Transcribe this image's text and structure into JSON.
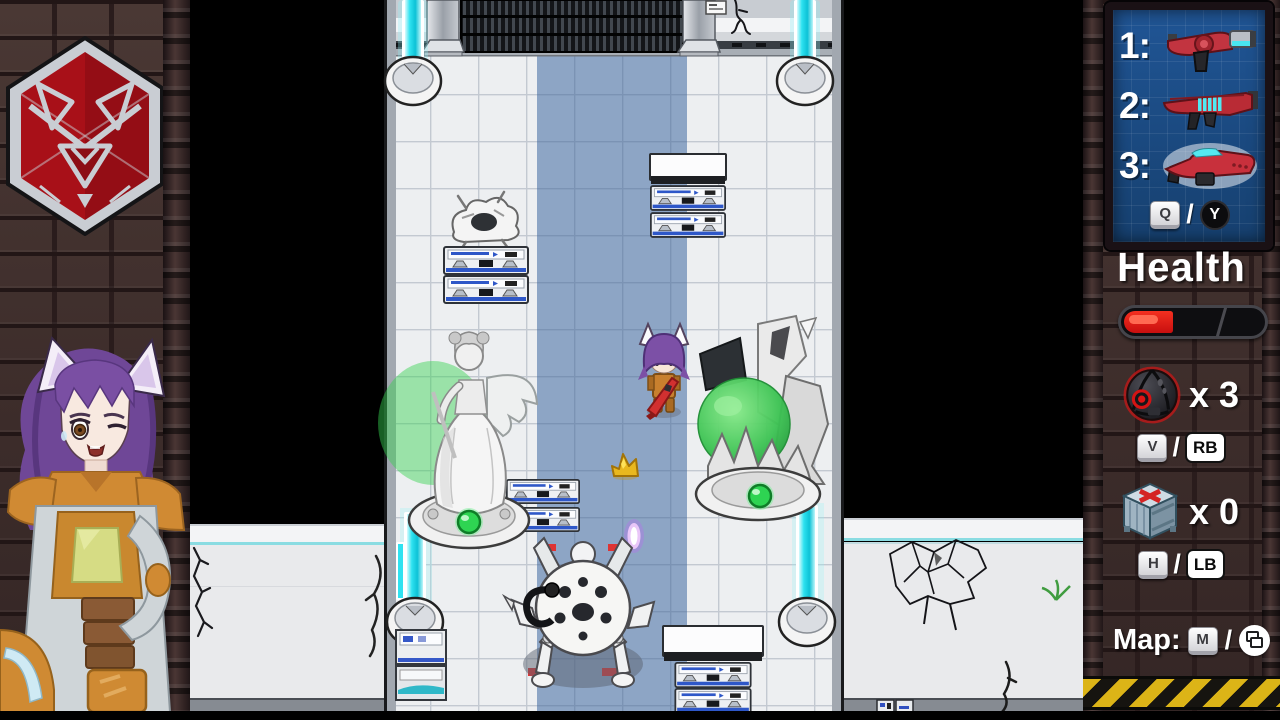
{
  "meta": {
    "description": "Top-down sci-fi action RPG gameplay screenshot with side HUD"
  },
  "left_panel": {
    "emblem_icon": "fox-hex-faction-emblem",
    "portrait_icon": "fox-eared-character-portrait",
    "colors": {
      "emblem_red": "#a81018",
      "emblem_metal": "#c9cdd3"
    }
  },
  "viewport": {
    "entities": {
      "player": "player-character-sprite",
      "enemy": "spider-robot-enemy",
      "statue_left": "winged-angel-statue",
      "statue_right": "crystal-statue",
      "wreck": "destroyed-robot-wreck",
      "pickup": "gold-pickup",
      "projectile": "plasma-projectile",
      "barrier": "cyan-energy-beam",
      "crates": "supply-crate-stack",
      "terminal": "control-terminal",
      "decal_blood": "blood-splatter",
      "decal_cracks": "wall-cracks"
    },
    "colors": {
      "floor": "#edeff1",
      "path_blue": "#8da5c5",
      "beam_cyan": "#2fe2f0"
    }
  },
  "hud": {
    "weapons": {
      "slots": [
        {
          "label": "1:",
          "icon": "red-pistol-icon"
        },
        {
          "label": "2:",
          "icon": "red-rifle-icon"
        },
        {
          "label": "3:",
          "icon": "red-shotgun-icon"
        }
      ],
      "keys": {
        "keyboard": "Q",
        "separator": "/",
        "gamepad": "Y"
      }
    },
    "health": {
      "label": "Health",
      "percent": 34,
      "fill_color": "#e01414"
    },
    "grenade": {
      "icon": "grenade-icon",
      "count": 3,
      "count_label": "x 3",
      "keys": {
        "keyboard": "V",
        "separator": "/",
        "gamepad": "RB"
      }
    },
    "supply": {
      "icon": "supply-crate-icon",
      "count": 0,
      "count_label": "x 0",
      "keys": {
        "keyboard": "H",
        "separator": "/",
        "gamepad": "LB"
      }
    },
    "map": {
      "label": "Map:",
      "keys": {
        "keyboard": "M",
        "separator": "/",
        "gamepad_icon": "view-button-icon"
      }
    },
    "colors": {
      "panel_blue": "#1d4e8c",
      "hazard_yellow": "#dcb417"
    }
  }
}
